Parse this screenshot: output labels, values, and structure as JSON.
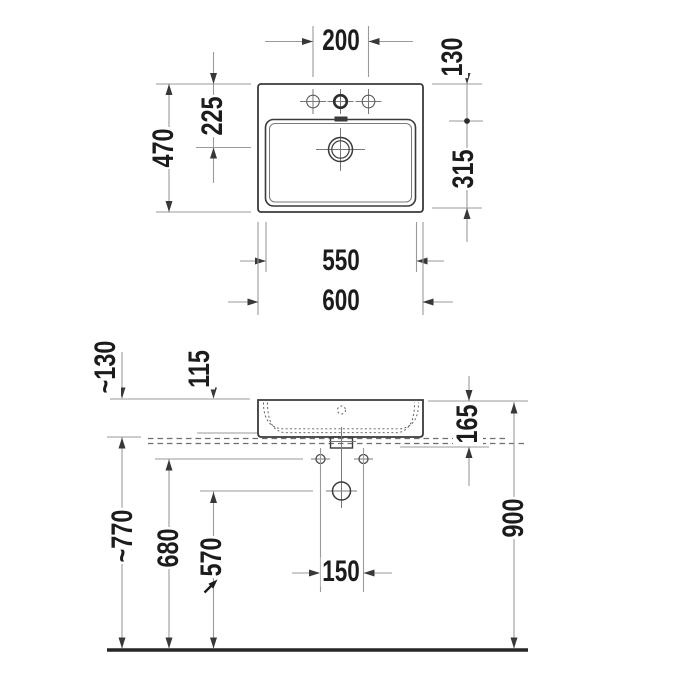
{
  "colors": {
    "object_line": "#3a3a3a",
    "dimension_line": "#9a9a9a",
    "label_text": "#1c1c1c",
    "background": "#ffffff"
  },
  "top_view": {
    "tap_hole_spacing": "200",
    "rear_edge_to_tap_axis": "130",
    "tap_axis_to_front_edge": "315",
    "rear_edge_to_drain": "225",
    "depth": "470",
    "basin_width": "550",
    "width": "600"
  },
  "front_view": {
    "rim_to_underside": "~130",
    "rim_to_deck_edge": "115",
    "rim_to_countertop": "165",
    "drain_outlet_height": "570",
    "fixing_hole_height": "680",
    "countertop_height": "~770",
    "rim_height": "900",
    "fixing_hole_spacing": "150"
  }
}
